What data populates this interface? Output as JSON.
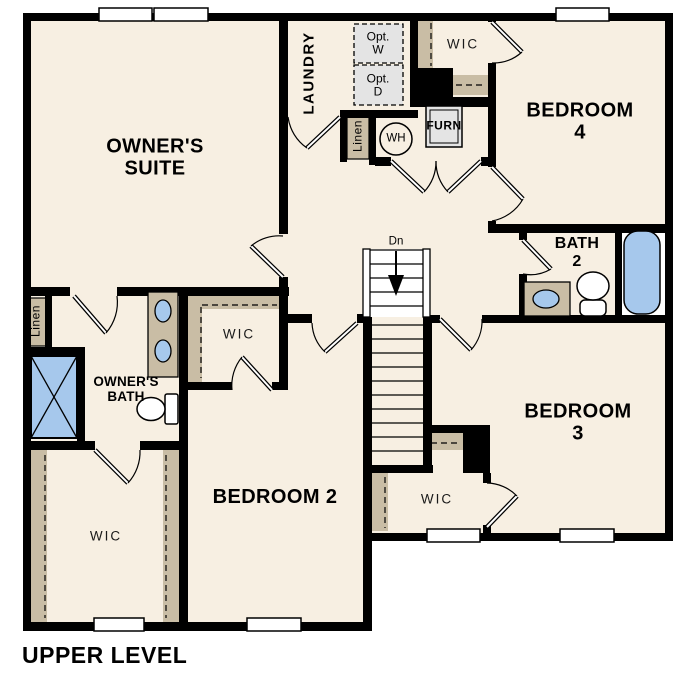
{
  "plan_title": "UPPER LEVEL",
  "rooms": {
    "owners_suite": "OWNER'S\nSUITE",
    "bedroom_2": "BEDROOM 2",
    "bedroom_3": "BEDROOM 3",
    "bedroom_4": "BEDROOM 4",
    "laundry": "LAUNDRY",
    "owners_bath": "OWNER'S\nBATH",
    "bath_2": "BATH\n2"
  },
  "closets": {
    "wic_top": "WIC",
    "wic_bedroom2": "WIC",
    "wic_owners": "WIC",
    "wic_bedroom3": "WIC",
    "linen_hall": "Linen",
    "linen_laundry": "Linen"
  },
  "fixtures": {
    "water_heater": "WH",
    "furnace": "FURN",
    "optional_washer": "Opt.\nW",
    "optional_dryer": "Opt.\nD"
  },
  "stairs": {
    "direction_label": "Dn"
  },
  "colors": {
    "floor": "#f7efe2",
    "wall": "#000000",
    "closet_tan": "#c9bda5",
    "fixture_blue": "#a6c8ec",
    "optional_gray": "#e4e4e4",
    "window_white": "#ffffff"
  }
}
